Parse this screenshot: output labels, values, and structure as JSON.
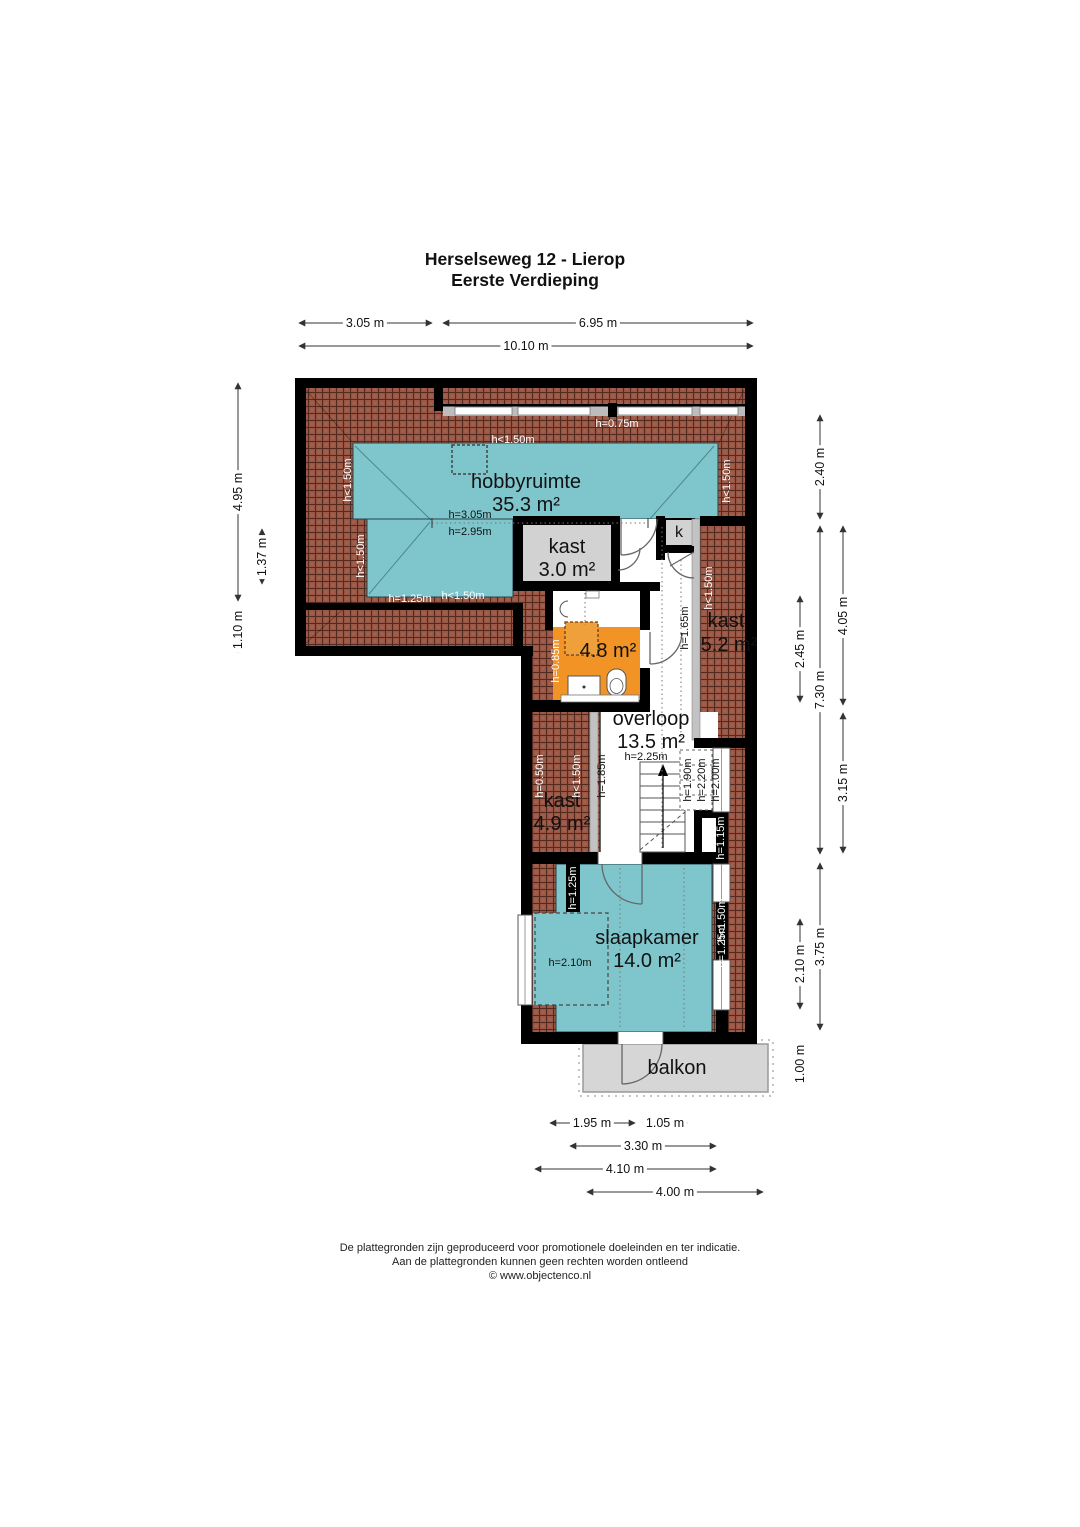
{
  "title": {
    "address": "Herselseweg 12 - Lierop",
    "floor": "Eerste Verdieping"
  },
  "rooms": {
    "hobbyruimte": {
      "name": "hobbyruimte",
      "area": "35.3 m²"
    },
    "kast_top": {
      "name": "kast",
      "area": "3.0 m²"
    },
    "k_closet": {
      "name": "k"
    },
    "kast_right": {
      "name": "kast",
      "area": "5.2 m²"
    },
    "badkamer": {
      "area": "4.8 m²"
    },
    "overloop": {
      "name": "overloop",
      "area": "13.5 m²"
    },
    "kast_lower": {
      "name": "kast",
      "area": "4.9 m²"
    },
    "slaapkamer": {
      "name": "slaapkamer",
      "area": "14.0 m²"
    },
    "balkon": {
      "name": "balkon"
    }
  },
  "height_labels": {
    "h075": "h=0.75m",
    "hlt150": "h<1.50m",
    "h305": "h=3.05m",
    "h295": "h=2.95m",
    "h125": "h=1.25m",
    "h165": "h=1.65m",
    "h085": "h=0.85m",
    "h225": "h=2.25m",
    "h050": "h=0.50m",
    "h185": "h=1.85m",
    "h190": "h=1.90m",
    "h220": "h=2.20m",
    "h200": "h=2.00m",
    "h115": "h=1.15m",
    "h210": "h=2.10m"
  },
  "dimensions": {
    "top": [
      "3.05 m",
      "6.95 m",
      "10.10 m"
    ],
    "left": [
      "4.95 m",
      "1.37 m",
      "1.10 m"
    ],
    "right": [
      "2.40 m",
      "4.05 m",
      "2.45 m",
      "7.30 m",
      "3.15 m",
      "3.75 m",
      "2.10 m",
      "1.00 m"
    ],
    "bottom": [
      "1.95 m",
      "1.05 m",
      "3.30 m",
      "4.10 m",
      "4.00 m"
    ]
  },
  "footer": {
    "line1": "De plattegronden zijn geproduceerd voor promotionele doeleinden en ter indicatie.",
    "line2": "Aan de plattegronden kunnen geen rechten worden ontleend",
    "line3": "© www.objectenco.nl"
  },
  "colors": {
    "room_teal": "#7fc5cc",
    "closet_gray": "#d2d2d2",
    "bathroom_orange": "#f29325",
    "attic_brick": "#9a5745",
    "wall_black": "#000000",
    "balcony_gray": "#d6d6d6"
  }
}
